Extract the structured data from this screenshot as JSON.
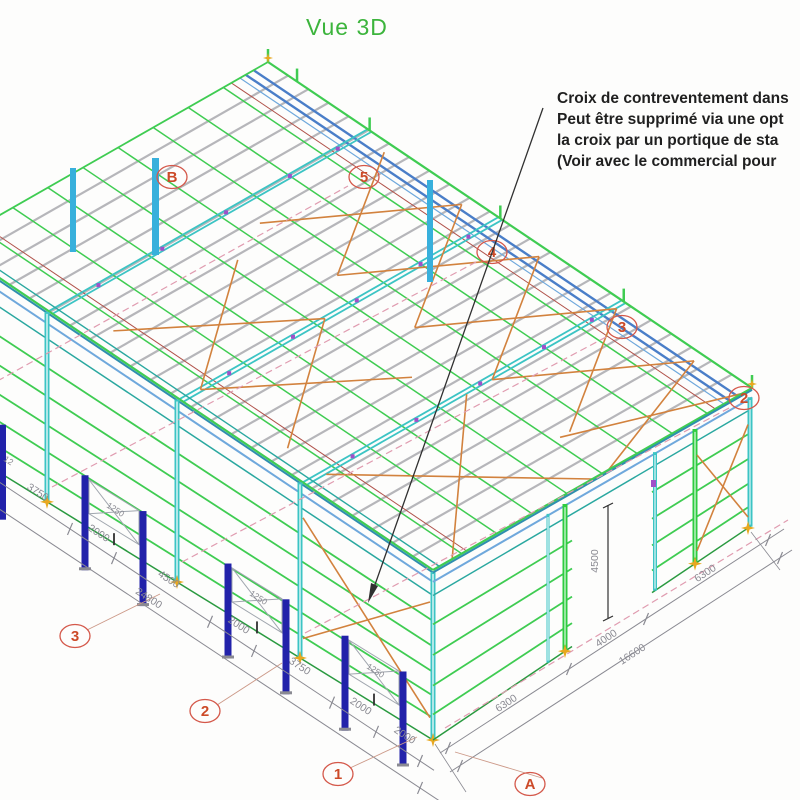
{
  "title": "Vue 3D",
  "annotation": {
    "lines": [
      "Croix de contreventement dans",
      "Peut être supprimé via une opt",
      "la croix par un portique de sta",
      "(Voir avec le commercial pour "
    ]
  },
  "grid_bubbles": [
    {
      "label": "B",
      "x": 172,
      "y": 177,
      "leader": null
    },
    {
      "label": "5",
      "x": 364,
      "y": 177,
      "leader": null
    },
    {
      "label": "4",
      "x": 492,
      "y": 252,
      "leader": null
    },
    {
      "label": "3",
      "x": 622,
      "y": 327,
      "leader": null
    },
    {
      "label": "2",
      "x": 744,
      "y": 398,
      "leader": null
    },
    {
      "label": "3",
      "x": 75,
      "y": 636,
      "leader": [
        160,
        594
      ]
    },
    {
      "label": "2",
      "x": 205,
      "y": 711,
      "leader": [
        282,
        663
      ]
    },
    {
      "label": "1",
      "x": 338,
      "y": 774,
      "leader": [
        417,
        737
      ]
    },
    {
      "label": "A",
      "x": 530,
      "y": 784,
      "leader": [
        455,
        752
      ]
    }
  ],
  "dimensions": [
    {
      "text": "3750",
      "x": 36,
      "y": 495,
      "rot": 33,
      "size": 10.5
    },
    {
      "text": "2000",
      "x": 97,
      "y": 536,
      "rot": 33,
      "size": 10.5
    },
    {
      "text": "4500",
      "x": 167,
      "y": 582,
      "rot": 33,
      "size": 10.5
    },
    {
      "text": "2000",
      "x": 237,
      "y": 628,
      "rot": 33,
      "size": 10.5
    },
    {
      "text": "3750",
      "x": 298,
      "y": 669,
      "rot": 33,
      "size": 10.5
    },
    {
      "text": "2000",
      "x": 359,
      "y": 709,
      "rot": 33,
      "size": 10.5
    },
    {
      "text": "2000",
      "x": 403,
      "y": 738,
      "rot": 33,
      "size": 10.5
    },
    {
      "text": "24800",
      "x": 147,
      "y": 601,
      "rot": 33,
      "size": 10.5
    },
    {
      "text": "6300",
      "x": 508,
      "y": 706,
      "rot": -33,
      "size": 10.5
    },
    {
      "text": "4000",
      "x": 608,
      "y": 641,
      "rot": -33,
      "size": 10.5
    },
    {
      "text": "6300",
      "x": 707,
      "y": 576,
      "rot": -33,
      "size": 10.5
    },
    {
      "text": "16600",
      "x": 634,
      "y": 657,
      "rot": -33,
      "size": 10.5
    },
    {
      "text": "4500",
      "x": 598,
      "y": 561,
      "rot": -90,
      "size": 10.5
    },
    {
      "text": "1250",
      "x": 114,
      "y": 512,
      "rot": 33,
      "size": 8.5
    },
    {
      "text": "1250",
      "x": 257,
      "y": 600,
      "rot": 33,
      "size": 8.5
    },
    {
      "text": "1250",
      "x": 374,
      "y": 673,
      "rot": 33,
      "size": 8.5
    },
    {
      "text": "12",
      "x": 7,
      "y": 463,
      "rot": 33,
      "size": 8.5
    }
  ],
  "colors": {
    "title_green": "#3cb43c",
    "note_black": "#1f1f1f",
    "structure_green": "#3fcc52",
    "dark_green": "#2a9a40",
    "teal": "#2aa8a0",
    "cyan_column": "#3cc4c4",
    "cyan_dark": "#1d8f9a",
    "steel_blue": "#4a7ec8",
    "light_blue": "#6fa8dc",
    "eave_teal": "#2f8fae",
    "purlin_gray": "#b6b6ba",
    "brace_orange": "#d2823e",
    "door_navy": "#2222aa",
    "axis_pink": "#e09cb0",
    "bubble_red": "#cc4a28",
    "bubble_stroke": "#d4584a",
    "leader_soft": "#cc9988",
    "dim_gray": "#8a8a92",
    "star_orange": "#e8a820",
    "leader_black": "#303030",
    "accent_purple": "#a050c8",
    "accent_red": "#b0524a",
    "blue_strip": "#38b0dc",
    "panel_gray": "#a0a6ae"
  }
}
